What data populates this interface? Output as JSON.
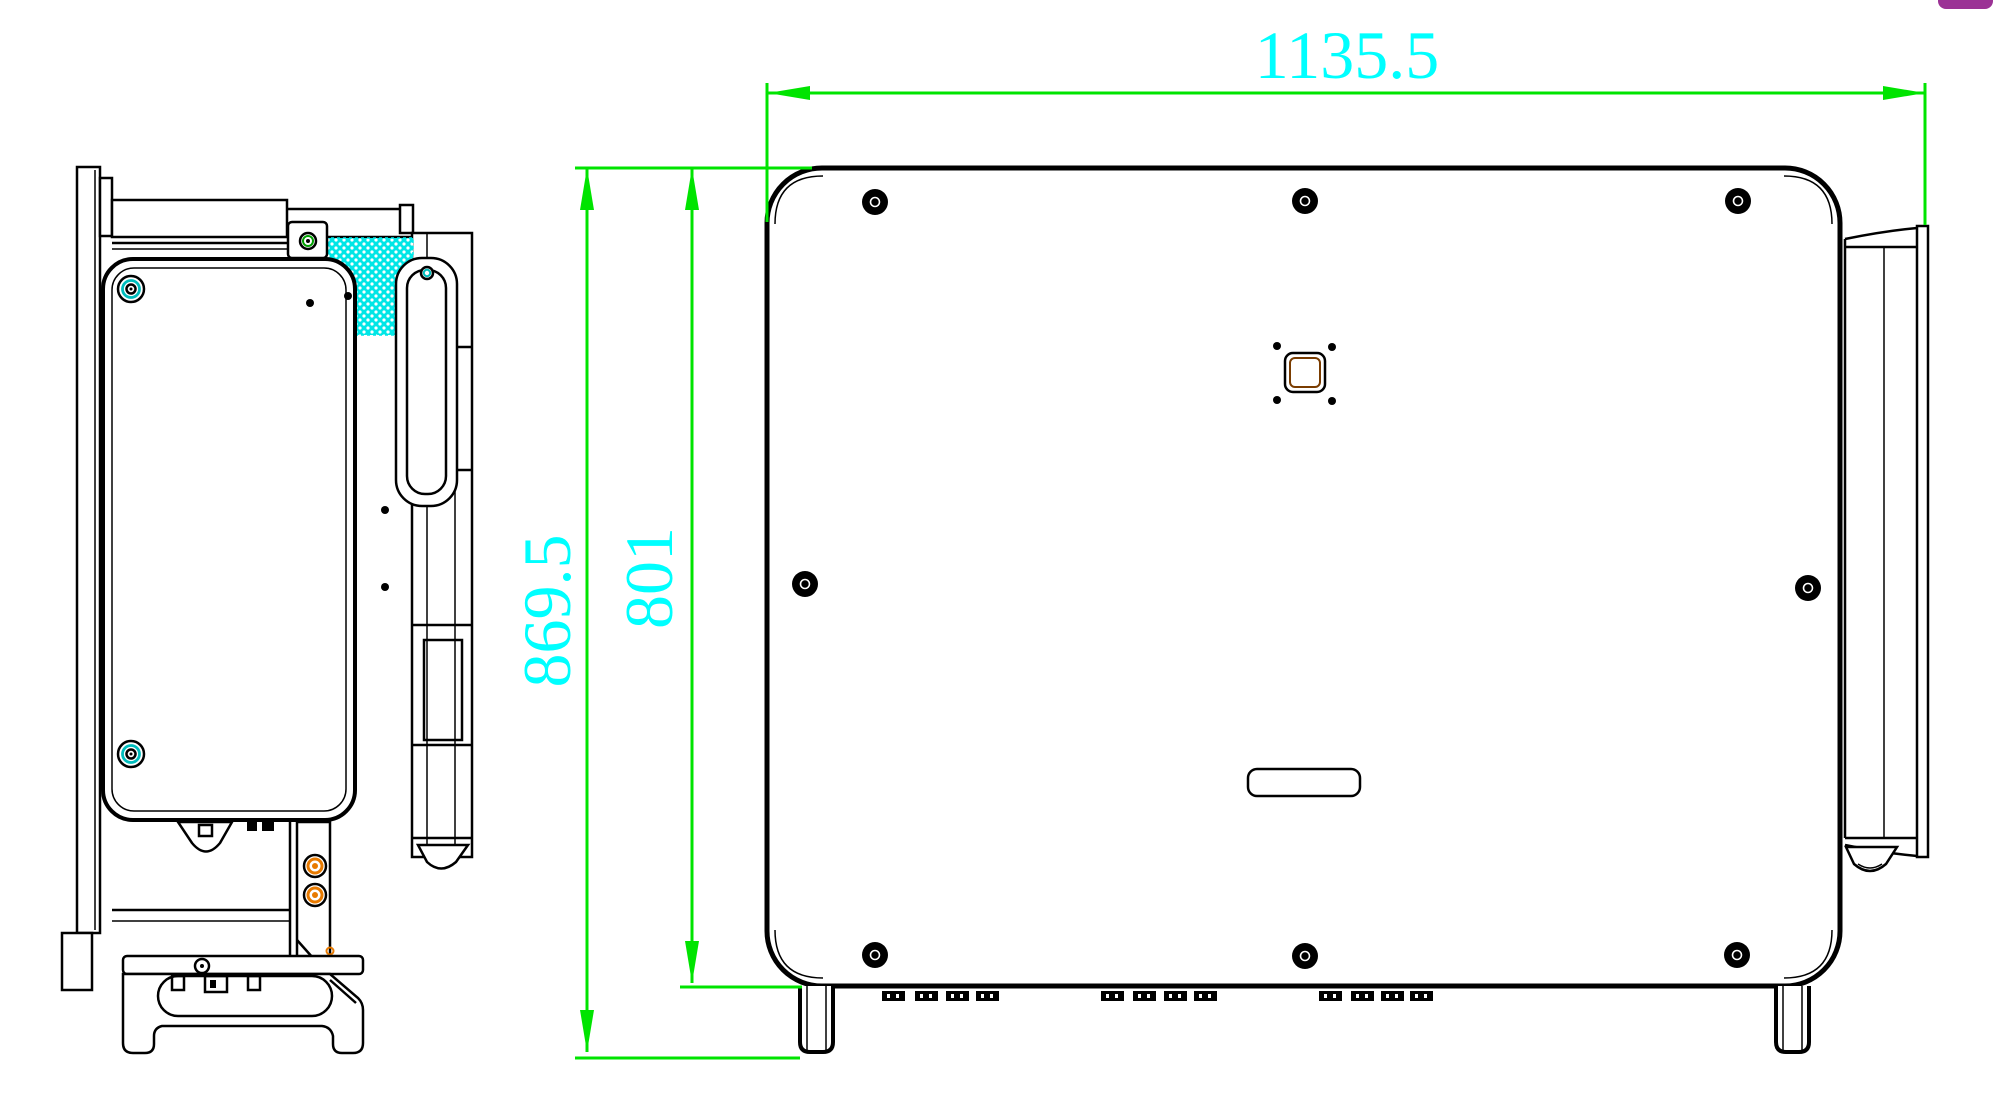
{
  "drawing": {
    "kind": "technical-dimension-drawing",
    "dimensions": {
      "width": "1135.5",
      "overall_height": "869.5",
      "body_height": "801"
    },
    "style": {
      "dimension_line_color": "#00e400",
      "dimension_text_color": "#00ffff",
      "outline_color": "#000000",
      "hatch_fill_color": "#00e6e6",
      "screw_ring_teal": "#00bdbd",
      "screw_ring_green": "#00a000",
      "terminal_ring_orange": "#e87a00",
      "center_square_accent": "#7a3c00",
      "corner_badge_color": "#9b3295"
    }
  }
}
